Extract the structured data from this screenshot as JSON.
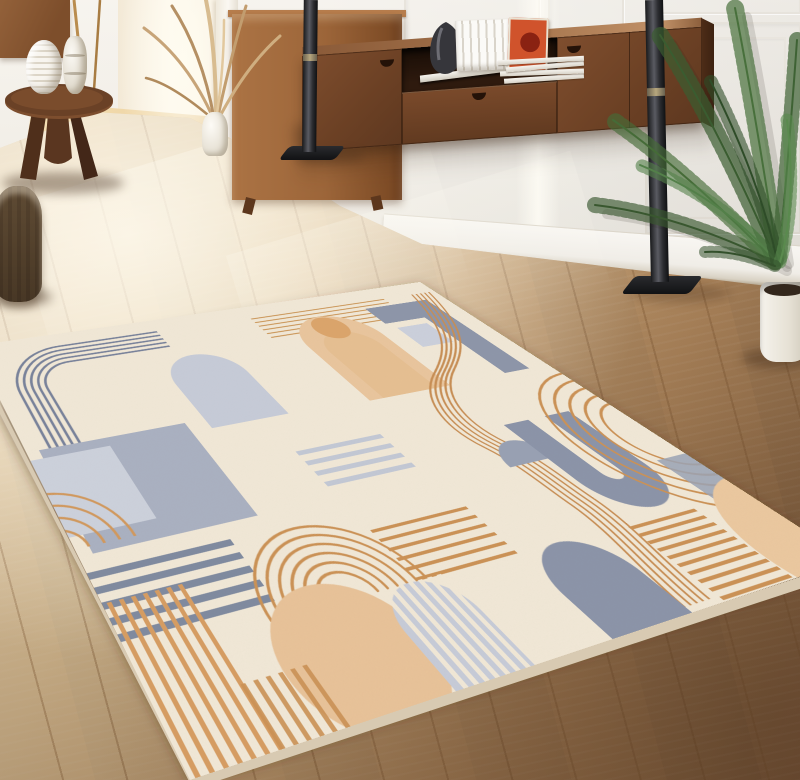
{
  "scene": {
    "title": "Sunlit living room with geometric art-deco area rug",
    "setting": "living room interior photograph, no visible text",
    "palette": {
      "wall_white": "#f3efe8",
      "floor_light_oak": "#e8d2a8",
      "floor_dark_foreground": "#8a674a",
      "walnut_console": "#6e4226",
      "oak_cabinet": "#9c6539",
      "rug_cream": "#f2e9d8",
      "rug_tan": "#c88e54",
      "rug_peach": "#eac69e",
      "rug_blue_gray": "#8b94a9",
      "rug_light_blue": "#c7ccd9",
      "plant_green": "#3f6234",
      "pole_metal": "#2c2d31"
    },
    "objects": [
      {
        "label": "paneled white wall with wainscot moldings"
      },
      {
        "label": "floating walnut media console with open shelf and drawers"
      },
      {
        "label": "row of white books on console"
      },
      {
        "label": "orange art book on console"
      },
      {
        "label": "black sculptural vase on console"
      },
      {
        "label": "stack of magazines on console"
      },
      {
        "label": "two dark metal pole stands"
      },
      {
        "label": "areca palm in white pot"
      },
      {
        "label": "round wooden side table with tripod base"
      },
      {
        "label": "white ribbed vase and white totem vase"
      },
      {
        "label": "dried grass arrangement in slim vase"
      },
      {
        "label": "gray carved stump stool"
      },
      {
        "label": "bright hallway doorway with sunlight"
      },
      {
        "label": "light oak plank floor"
      },
      {
        "label": "cream geometric rug with arches, arcs, circle and stripe motifs"
      }
    ],
    "rug": {
      "style": "art-deco geometric",
      "motifs": [
        "blue racetrack corner arcs",
        "light blue filled arch",
        "blue-gray speckled block",
        "gray stripe group",
        "orange vertical stripes",
        "orange rainbow arcs",
        "large peach circle",
        "peach keyhole arch",
        "tan winding multi-line river",
        "blue horseshoe shape",
        "tan quarter arcs",
        "gray dome with orange ladder stripes",
        "peach corner quarter-disc"
      ]
    }
  }
}
